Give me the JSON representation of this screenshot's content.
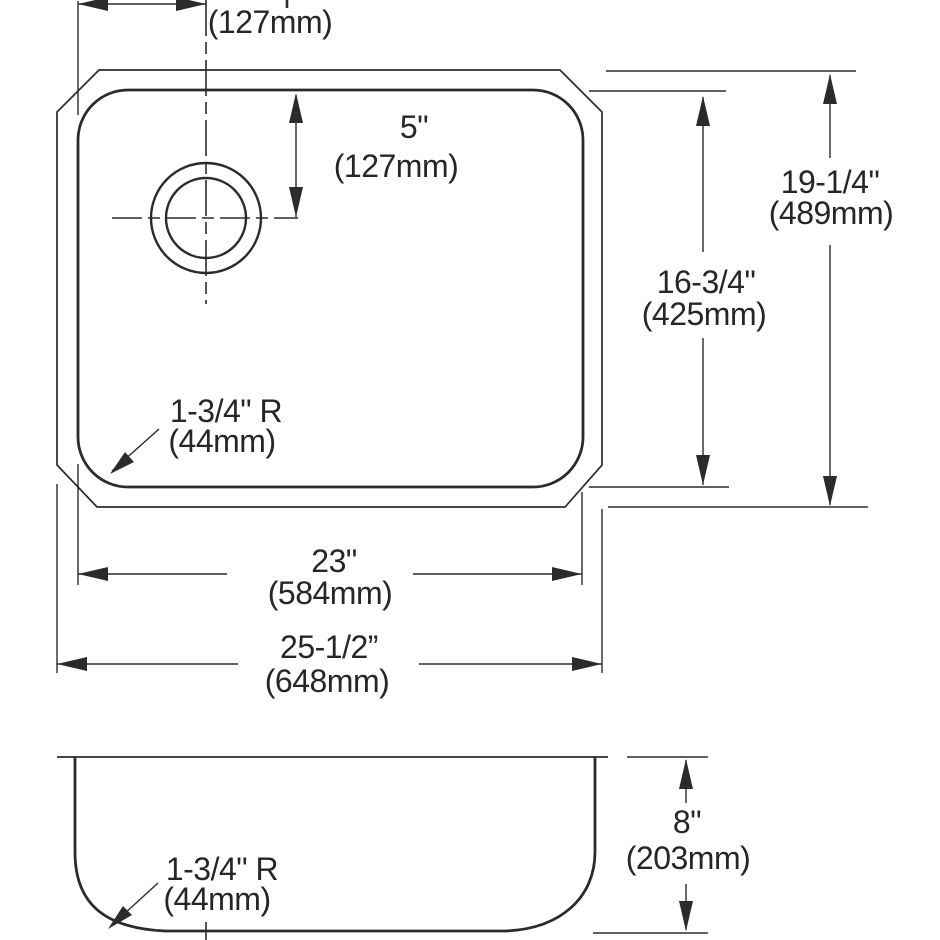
{
  "colors": {
    "line": "#2b2b2b",
    "background": "#ffffff"
  },
  "views": {
    "plan": {
      "dim_hole_from_left_mm": "(127mm)",
      "dim_hole_from_top_in": "5\"",
      "dim_hole_from_top_mm": "(127mm)",
      "dim_inner_height_in": "16-3/4\"",
      "dim_inner_height_mm": "(425mm)",
      "dim_outer_height_in": "19-1/4\"",
      "dim_outer_height_mm": "(489mm)",
      "corner_radius_in": "1-3/4\" R",
      "corner_radius_mm": "(44mm)",
      "dim_inner_width_in": "23\"",
      "dim_inner_width_mm": "(584mm)",
      "dim_outer_width_in": "25-1/2”",
      "dim_outer_width_mm": "(648mm)"
    },
    "section": {
      "corner_radius_in": "1-3/4\" R",
      "corner_radius_mm": "(44mm)",
      "dim_depth_in": "8\"",
      "dim_depth_mm": "(203mm)"
    }
  }
}
